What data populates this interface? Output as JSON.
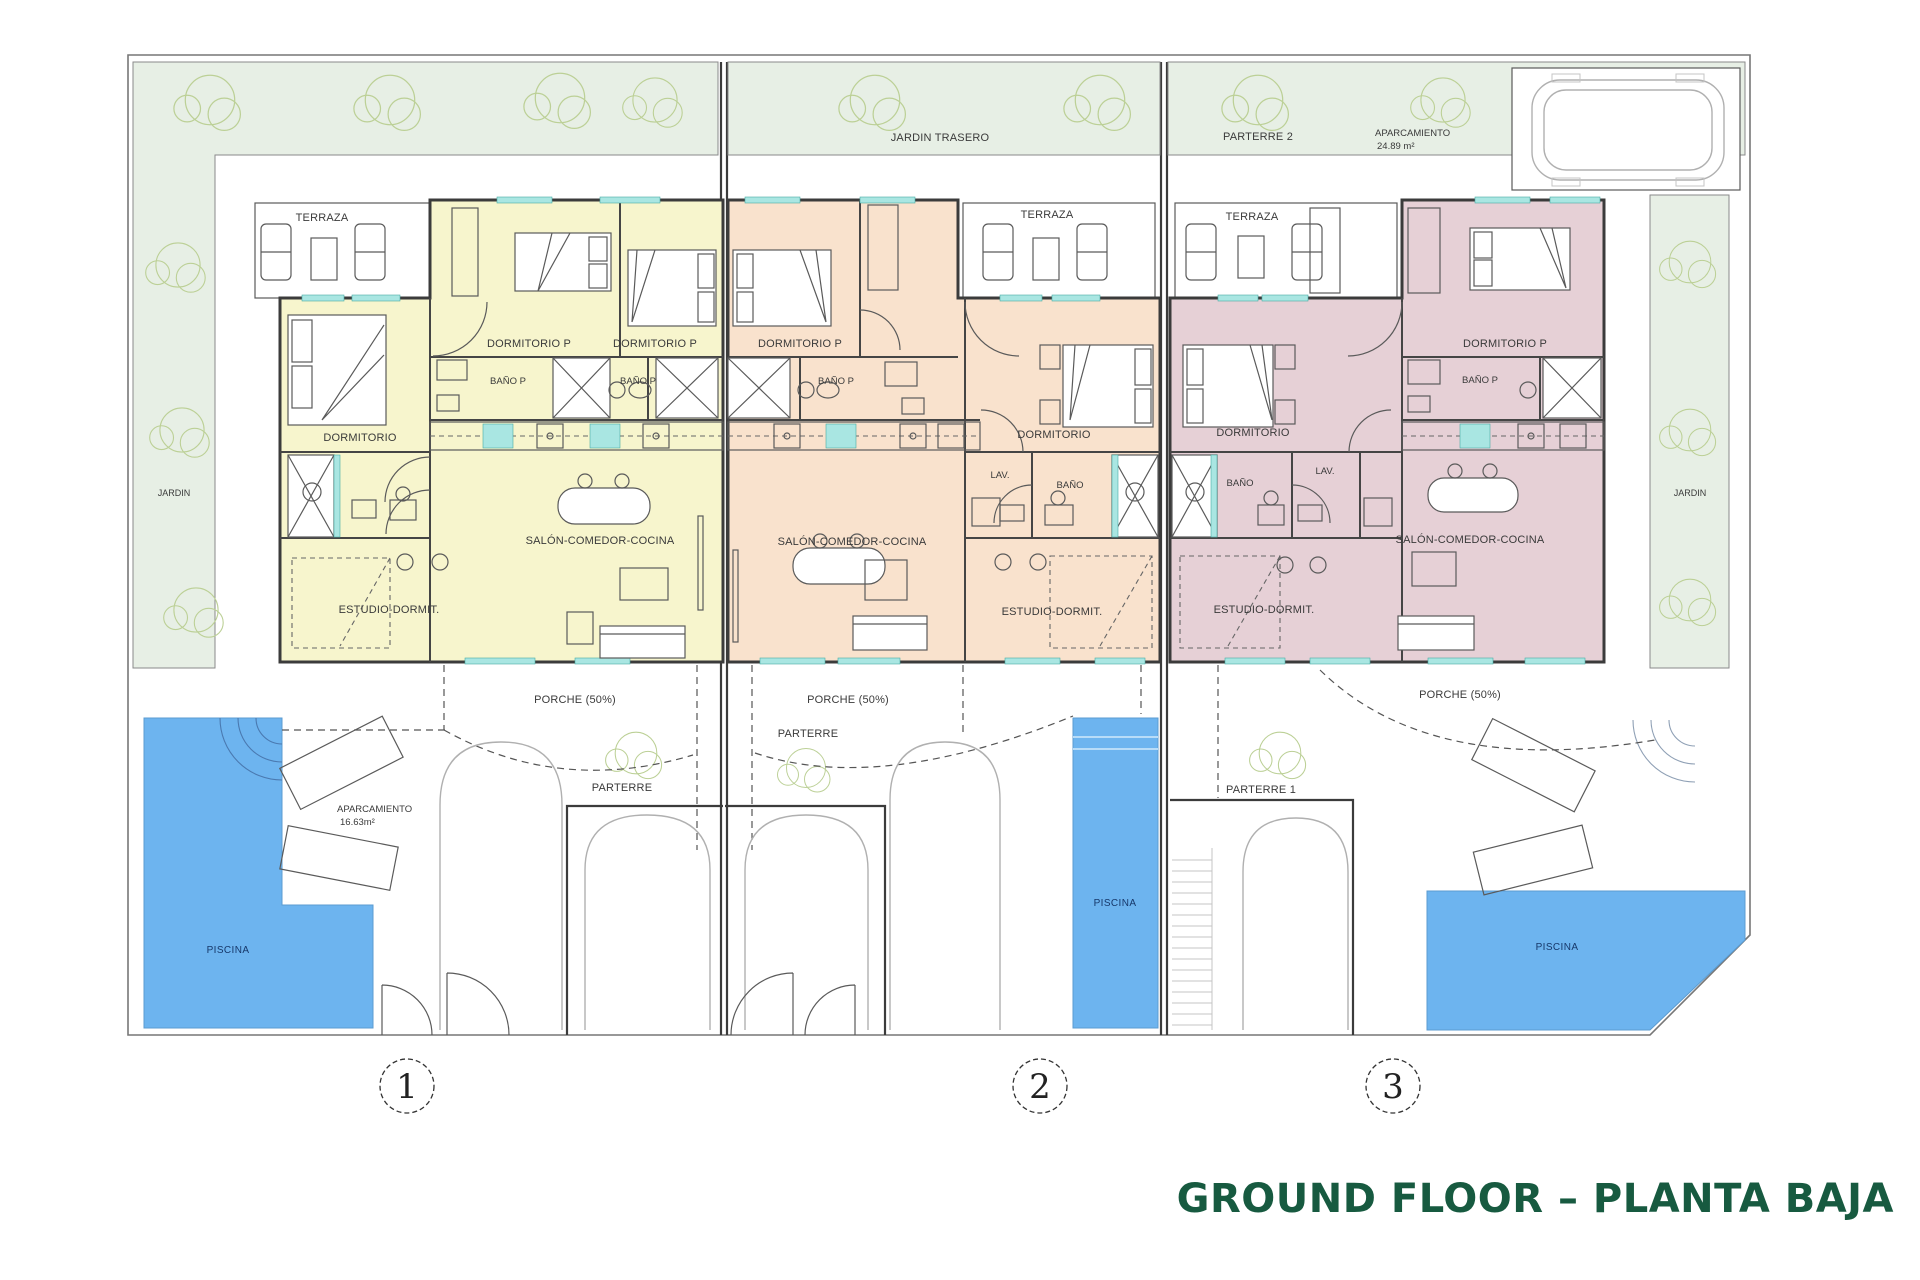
{
  "title": "GROUND FLOOR – PLANTA BAJA",
  "site": {
    "jardin_left": "JARDIN",
    "jardin_trasero": "JARDIN TRASERO",
    "parterre_2": "PARTERRE 2",
    "aparcamiento_top": "APARCAMIENTO",
    "aparcamiento_top_area": "24.89 m²",
    "jardin_right": "JARDIN",
    "parterre_mid": "PARTERRE",
    "parterre_low": "PARTERRE",
    "parterre_1": "PARTERRE 1",
    "aparcamiento_1": "APARCAMIENTO",
    "aparcamiento_1_area": "16.63m²",
    "piscina_left": "PISCINA",
    "piscina_mid": "PISCINA",
    "piscina_right": "PISCINA"
  },
  "houses": [
    {
      "number": "1",
      "rooms": {
        "terraza": "TERRAZA",
        "dormitorio_p_1": "DORMITORIO P",
        "dormitorio_p_2": "DORMITORIO P",
        "bano_p_1": "BAÑO P",
        "bano_p_2": "BAÑO P",
        "dormitorio": "DORMITORIO",
        "salon": "SALÓN-COMEDOR-COCINA",
        "estudio": "ESTUDIO-DORMIT.",
        "porche": "PORCHE (50%)"
      }
    },
    {
      "number": "2",
      "rooms": {
        "terraza": "TERRAZA",
        "dormitorio_p": "DORMITORIO P",
        "bano_p": "BAÑO P",
        "dormitorio": "DORMITORIO",
        "lav": "LAV.",
        "bano": "BAÑO",
        "salon": "SALÓN-COMEDOR-COCINA",
        "estudio": "ESTUDIO-DORMIT.",
        "porche": "PORCHE (50%)"
      }
    },
    {
      "number": "3",
      "rooms": {
        "terraza": "TERRAZA",
        "dormitorio": "DORMITORIO",
        "bano": "BAÑO",
        "lav": "LAV.",
        "dormitorio_p": "DORMITORIO P",
        "bano_p": "BAÑO P",
        "salon": "SALÓN-COMEDOR-COCINA",
        "estudio": "ESTUDIO-DORMIT.",
        "porche": "PORCHE (50%)"
      }
    }
  ],
  "colors": {
    "house_1": "#f7f5cd",
    "house_2": "#f9e2cd",
    "house_3": "#e6d0d6",
    "pool": "#6db4ef",
    "garden": "#e7efe5",
    "window": "#a9e6e2",
    "title": "#175a40",
    "wall": "#3b3b3b"
  }
}
